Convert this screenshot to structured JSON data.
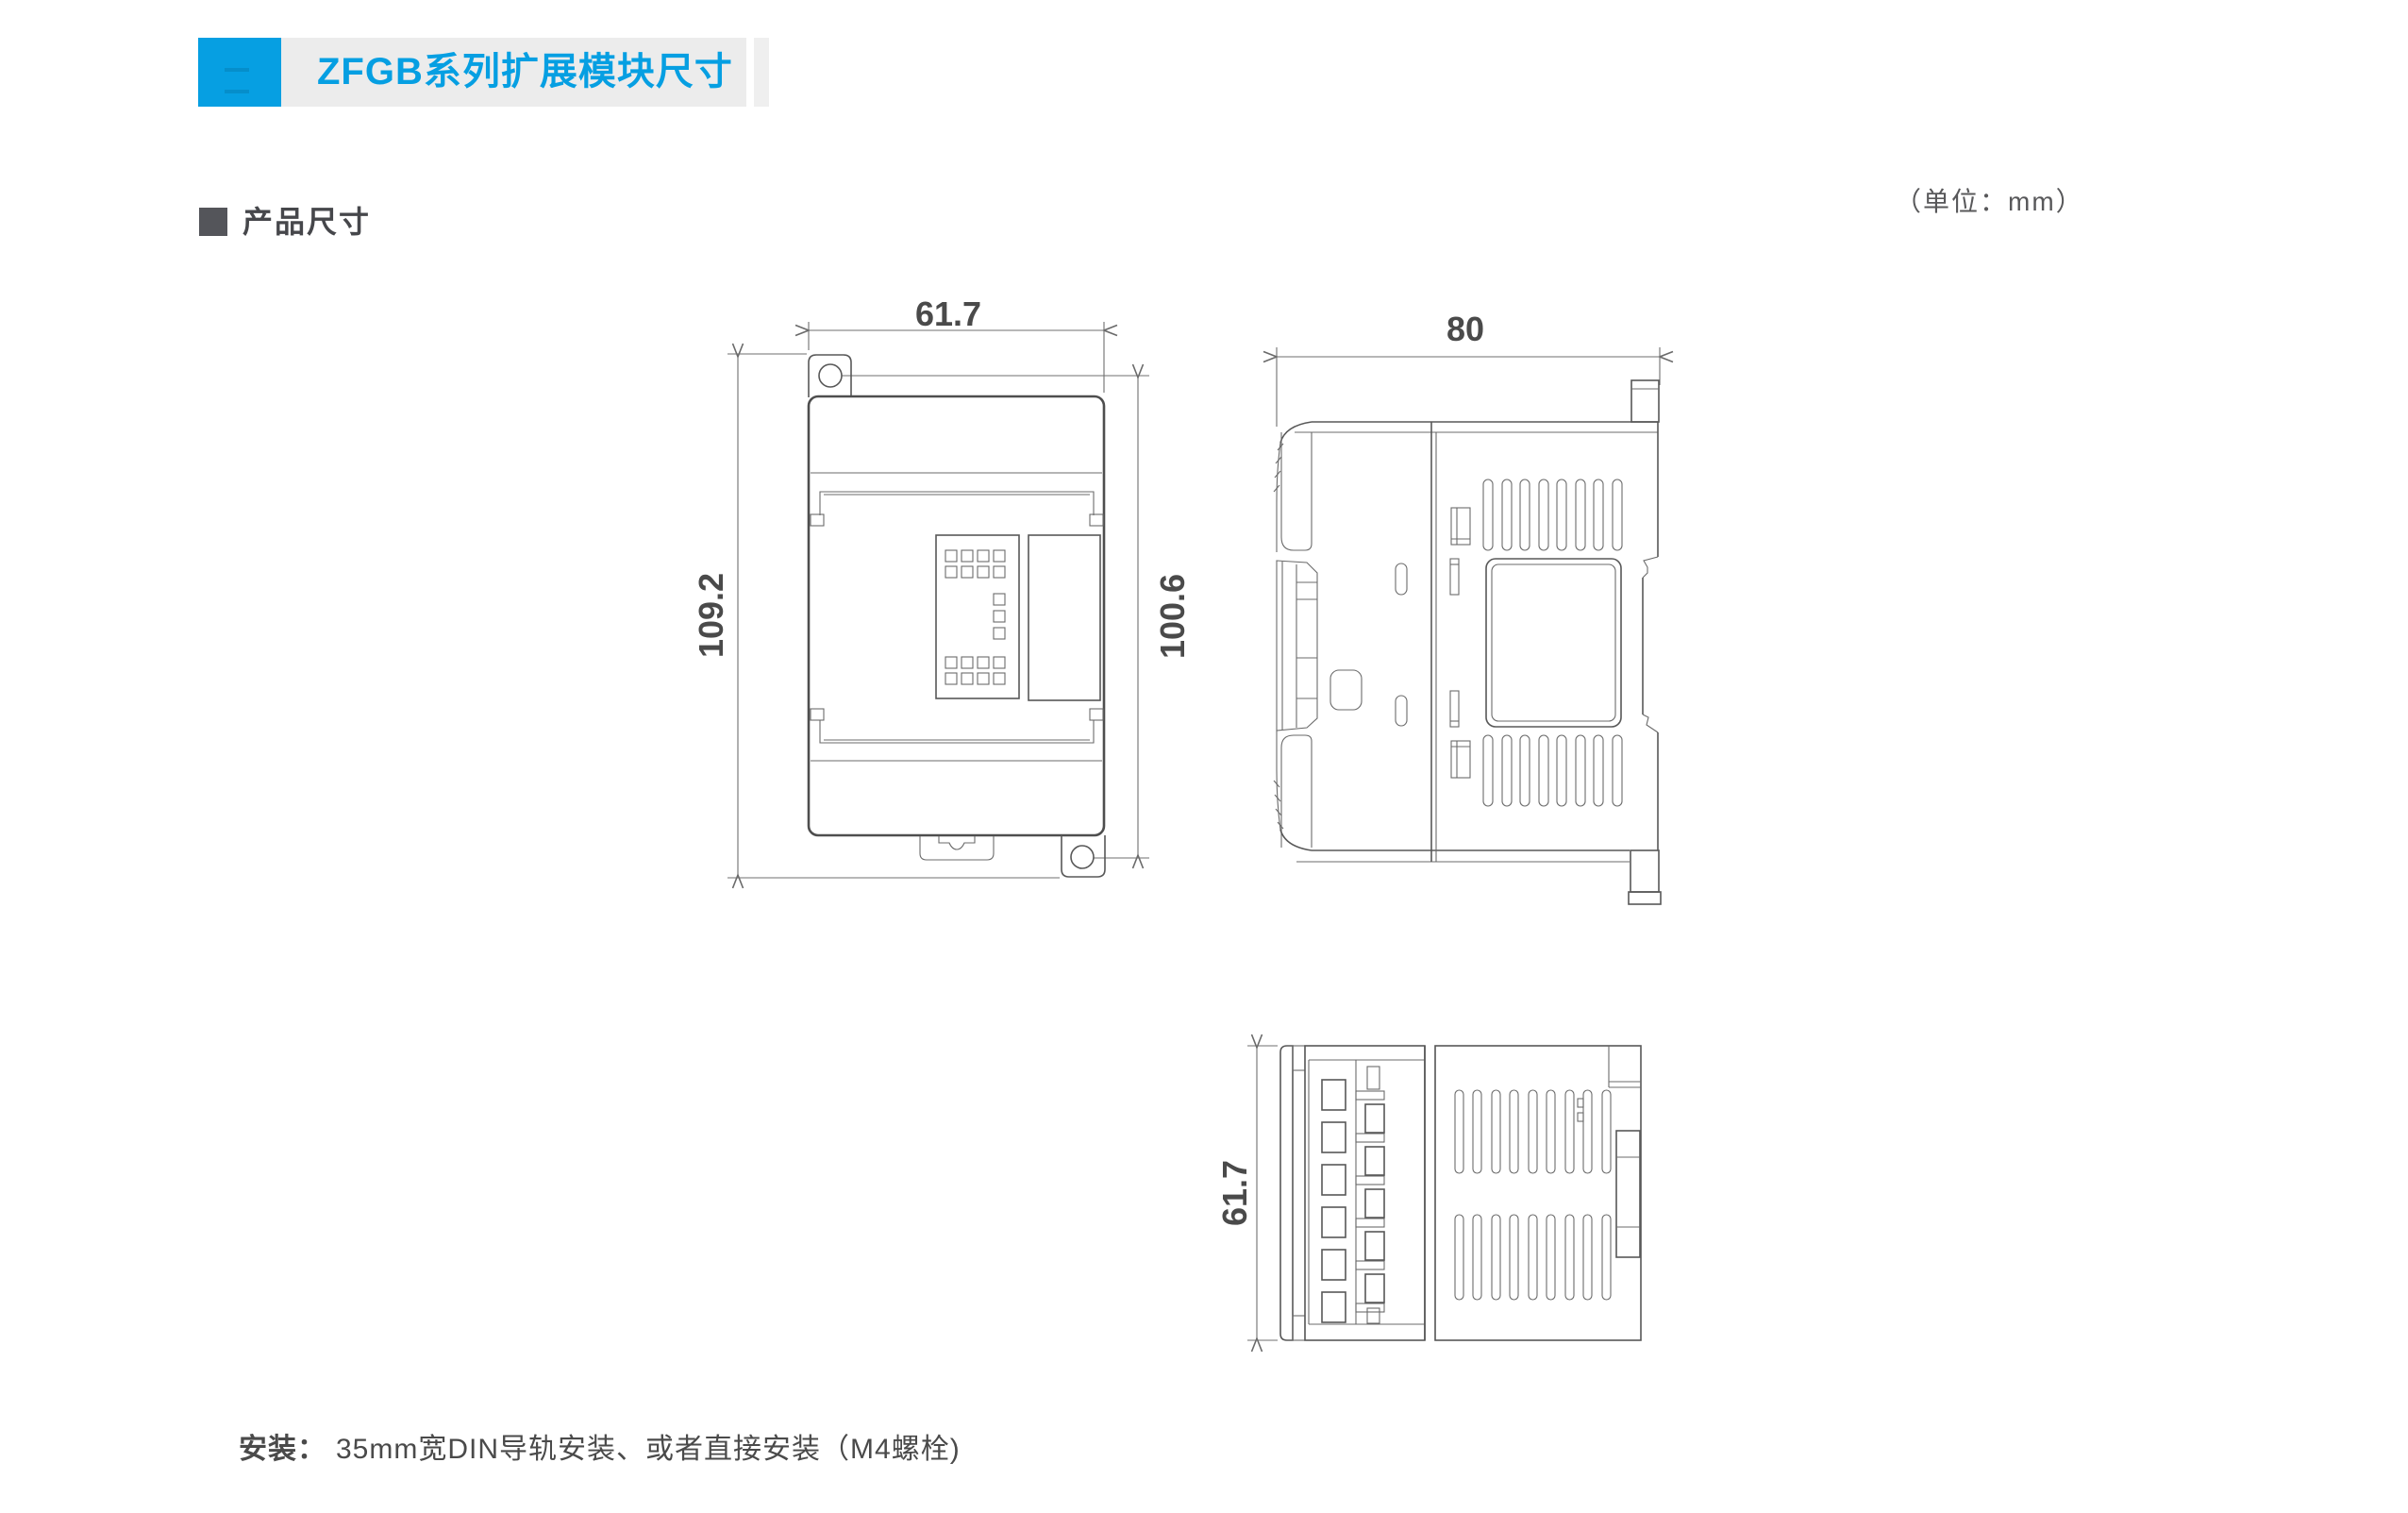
{
  "header": {
    "title": "ZFGB系列扩展模块尺寸",
    "accent_color": "#069fe2",
    "bar_color": "#ececec"
  },
  "section": {
    "title": "产品尺寸"
  },
  "units_note": "（单位：mm）",
  "drawings": {
    "front_width": "61.7",
    "front_total_height": "109.2",
    "front_mounting_pitch": "100.6",
    "side_depth": "80",
    "top_width": "61.7"
  },
  "footer": {
    "label": "安装：",
    "text": "35mm宽DIN导轨安装、或者直接安装（M4螺栓)"
  }
}
